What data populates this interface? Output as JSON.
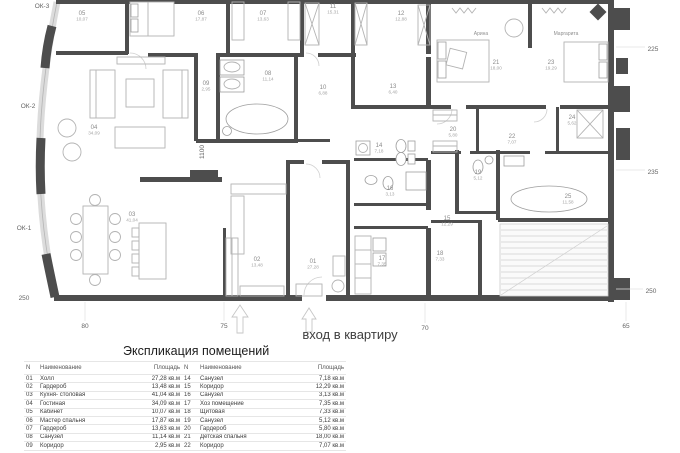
{
  "colors": {
    "wall": "#4d4d4d",
    "furniture": "#b3b3b3",
    "glazing": "#dcdcdc",
    "room_number": "#8a8a8a",
    "room_area": "#a3a3a3",
    "dim_text": "#646464",
    "table_text": "#3c3c3c",
    "table_line": "#e6e6e6"
  },
  "plan": {
    "entrance_label": "вход в квартиру",
    "rooms": [
      {
        "num": "05",
        "area": "10,07",
        "x": 82,
        "y": 15
      },
      {
        "num": "06",
        "area": "17,87",
        "x": 201,
        "y": 15
      },
      {
        "num": "07",
        "area": "13,63",
        "x": 263,
        "y": 15
      },
      {
        "num": "11",
        "area": "15,31",
        "x": 333,
        "y": 8
      },
      {
        "num": "12",
        "area": "12,88",
        "x": 401,
        "y": 15
      },
      {
        "num": "21",
        "area": "18,00",
        "x": 496,
        "y": 64
      },
      {
        "num": "23",
        "area": "19,29",
        "x": 551,
        "y": 64
      },
      {
        "num": "09",
        "area": "2,95",
        "x": 206,
        "y": 85
      },
      {
        "num": "08",
        "area": "11,14",
        "x": 268,
        "y": 75
      },
      {
        "num": "10",
        "area": "6,88",
        "x": 323,
        "y": 89
      },
      {
        "num": "13",
        "area": "6,40",
        "x": 393,
        "y": 88
      },
      {
        "num": "04",
        "area": "34,09",
        "x": 94,
        "y": 129
      },
      {
        "num": "14",
        "area": "7,18",
        "x": 379,
        "y": 147
      },
      {
        "num": "20",
        "area": "5,80",
        "x": 453,
        "y": 131
      },
      {
        "num": "22",
        "area": "7,07",
        "x": 512,
        "y": 138
      },
      {
        "num": "24",
        "area": "5,62",
        "x": 572,
        "y": 119
      },
      {
        "num": "19",
        "area": "5,12",
        "x": 478,
        "y": 174
      },
      {
        "num": "25",
        "area": "11,58",
        "x": 568,
        "y": 198
      },
      {
        "num": "15",
        "area": "12,29",
        "x": 447,
        "y": 220
      },
      {
        "num": "16",
        "area": "3,13",
        "x": 390,
        "y": 190
      },
      {
        "num": "01",
        "area": "27,28",
        "x": 313,
        "y": 263
      },
      {
        "num": "02",
        "area": "13,48",
        "x": 257,
        "y": 261
      },
      {
        "num": "03",
        "area": "41,04",
        "x": 132,
        "y": 216
      },
      {
        "num": "17",
        "area": "7,35",
        "x": 382,
        "y": 260
      },
      {
        "num": "18",
        "area": "7,33",
        "x": 440,
        "y": 255
      }
    ],
    "names": [
      {
        "text": "Арина",
        "x": 481,
        "y": 35
      },
      {
        "text": "Маргарита",
        "x": 566,
        "y": 35
      }
    ],
    "dims": [
      {
        "text": "ОК-3",
        "x": 42,
        "y": 8
      },
      {
        "text": "ОК-2",
        "x": 28,
        "y": 108
      },
      {
        "text": "ОК-1",
        "x": 24,
        "y": 230
      },
      {
        "text": "250",
        "x": 24,
        "y": 300
      },
      {
        "text": "225",
        "x": 653,
        "y": 51
      },
      {
        "text": "235",
        "x": 653,
        "y": 174
      },
      {
        "text": "250",
        "x": 651,
        "y": 293
      },
      {
        "text": "80",
        "x": 85,
        "y": 328
      },
      {
        "text": "75",
        "x": 224,
        "y": 328
      },
      {
        "text": "70",
        "x": 425,
        "y": 330
      },
      {
        "text": "65",
        "x": 626,
        "y": 328
      },
      {
        "text": "1100",
        "x": 204,
        "y": 152,
        "rot": -90
      }
    ]
  },
  "table": {
    "title": "Экспликация помещений",
    "headers": [
      "N",
      "Наименование",
      "Площадь",
      "N",
      "Наименование",
      "Площадь"
    ],
    "left_rows": [
      [
        "01",
        "Холл",
        "27,28 кв.м"
      ],
      [
        "02",
        "Гардероб",
        "13,48 кв.м"
      ],
      [
        "03",
        "Кухня- столовая",
        "41,04 кв.м"
      ],
      [
        "04",
        "Гостиная",
        "34,09 кв.м"
      ],
      [
        "05",
        "Кабинет",
        "10,07 кв.м"
      ],
      [
        "06",
        "Мастер спальня",
        "17,87 кв.м"
      ],
      [
        "07",
        "Гардероб",
        "13,63 кв.м"
      ],
      [
        "08",
        "Санузел",
        "11,14 кв.м"
      ],
      [
        "09",
        "Коридор",
        "2,95 кв.м"
      ]
    ],
    "right_rows": [
      [
        "14",
        "Санузел",
        "7,18 кв.м"
      ],
      [
        "15",
        "Коридор",
        "12,29 кв.м"
      ],
      [
        "16",
        "Санузел",
        "3,13 кв.м"
      ],
      [
        "17",
        "Хоз помещение",
        "7,35 кв.м"
      ],
      [
        "18",
        "Щитовая",
        "7,33 кв.м"
      ],
      [
        "19",
        "Санузел",
        "5,12 кв.м"
      ],
      [
        "20",
        "Гардероб",
        "5,80 кв.м"
      ],
      [
        "21",
        "Детская спальня",
        "18,00 кв.м"
      ],
      [
        "22",
        "Коридор",
        "7,07 кв.м"
      ]
    ]
  }
}
